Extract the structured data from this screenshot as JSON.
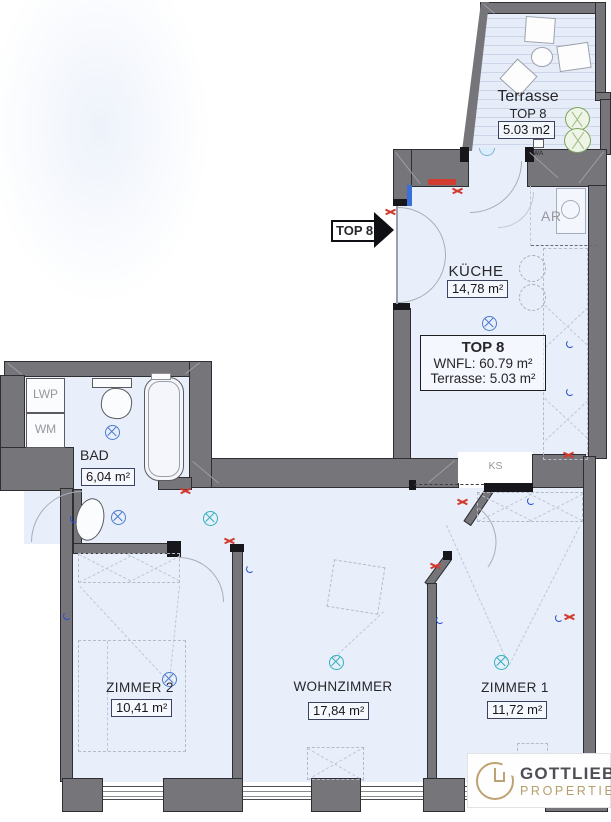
{
  "plan": {
    "rooms": [
      {
        "id": "terrasse",
        "name": "Terrasse",
        "sub": "TOP 8",
        "area": "5.03 m2"
      },
      {
        "id": "kueche",
        "name": "KÜCHE",
        "area": "14,78 m²"
      },
      {
        "id": "bad",
        "name": "BAD",
        "area": "6,04 m²"
      },
      {
        "id": "zimmer2",
        "name": "ZIMMER 2",
        "area": "10,41 m²"
      },
      {
        "id": "wohnzimmer",
        "name": "WOHNZIMMER",
        "area": "17,84 m²"
      },
      {
        "id": "zimmer1",
        "name": "ZIMMER 1",
        "area": "11,72 m²"
      }
    ],
    "info_box": {
      "title": "TOP 8",
      "wnfl": "WNFL: 60.79 m²",
      "terrasse": "Terrasse: 5.03 m²"
    },
    "annotations": {
      "entry_arrow": "TOP 8",
      "wa": "WA",
      "ar": "AR",
      "ks": "KS",
      "lwp": "LWP",
      "wm": "WM"
    },
    "colors": {
      "wall": "#75757a",
      "floor": "#e9effa",
      "accent_blue": "#4a7ad0",
      "accent_teal": "#2fb0bd",
      "radiator_red": "#d23b2f",
      "logo_gold": "#b5a06b",
      "logo_dark": "#4e4f54"
    }
  },
  "branding": {
    "name": "GOTTLIEB",
    "tagline": "PROPERTIES"
  }
}
